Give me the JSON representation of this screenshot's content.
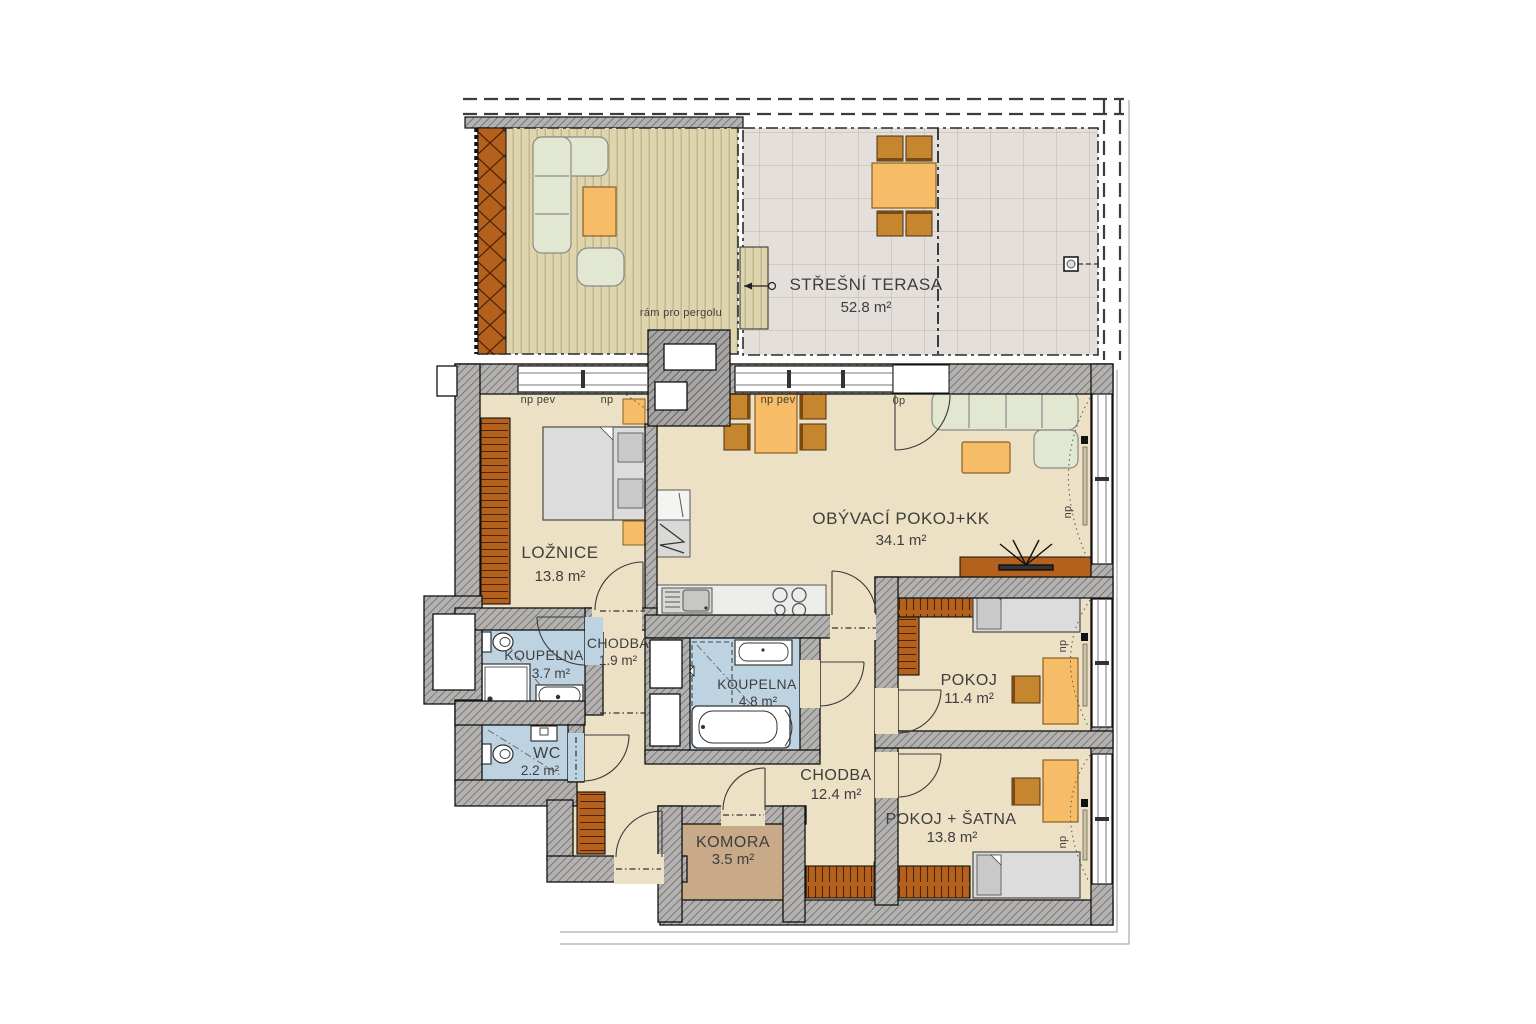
{
  "plan_title": "floor-plan",
  "terrace": {
    "name": "STŘEŠNÍ TERASA",
    "area": "52.8 m²",
    "pergola_note": "rám pro pergolu"
  },
  "rooms": {
    "obyvaci": {
      "name": "OBÝVACÍ POKOJ+KK",
      "area": "34.1 m²"
    },
    "loznice": {
      "name": "LOŽNICE",
      "area": "13.8 m²"
    },
    "koupelna_mala": {
      "name": "KOUPELNA",
      "area": "3.7 m²"
    },
    "chodba_mala": {
      "name": "CHODBA",
      "area": "1.9 m²"
    },
    "wc": {
      "name": "WC",
      "area": "2.2 m²"
    },
    "koupelna_velka": {
      "name": "KOUPELNA",
      "area": "4.8 m²"
    },
    "chodba_velka": {
      "name": "CHODBA",
      "area": "12.4 m²"
    },
    "komora": {
      "name": "KOMORA",
      "area": "3.5 m²"
    },
    "pokoj": {
      "name": "POKOJ",
      "area": "11.4 m²"
    },
    "pokoj_satna": {
      "name": "POKOJ + ŠATNA",
      "area": "13.8 m²"
    }
  },
  "opening_labels": {
    "fixed": "np pev",
    "openable": "np",
    "door_zero": "0p"
  },
  "colors": {
    "apartment_floor": "#ece1c4",
    "bath_floor": "#bed3e2",
    "storage_floor": "#c8a988",
    "terrace_deck": "#ded5ae",
    "terrace_tiles": "#e4dfda",
    "wall_gray": "#b3b2b0",
    "furniture_orange": "#f6bc67",
    "chair_brown": "#c6862f",
    "wardrobe_orange": "#b4611d",
    "sofa_green": "#e2e7d2",
    "bed_gray": "#dcdcdc",
    "text": "#3e3e3e"
  }
}
